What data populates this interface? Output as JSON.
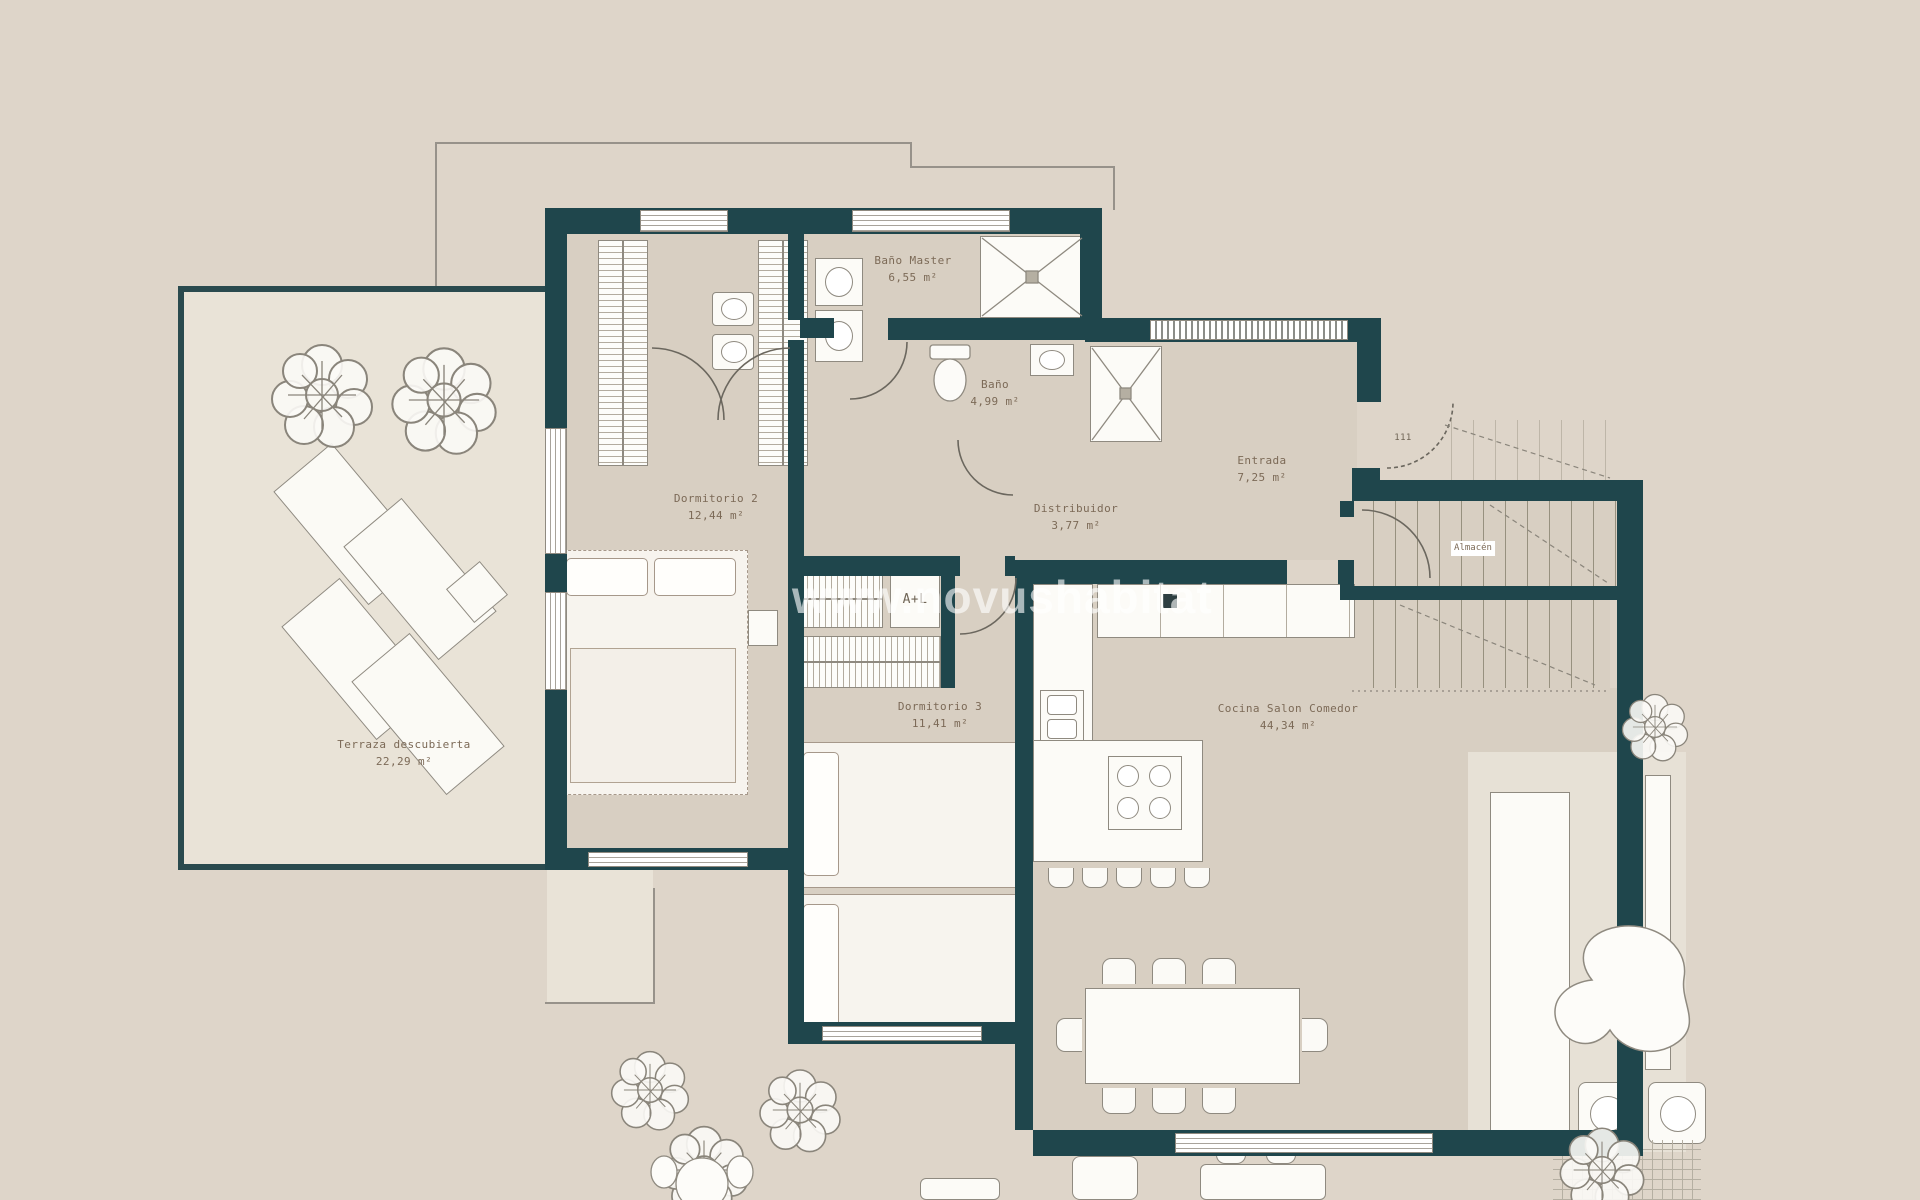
{
  "watermark": {
    "text": "www.novushabitat"
  },
  "entrance": {
    "door_number": "111"
  },
  "rooms": {
    "bano_master": {
      "name": "Baño Master",
      "area": "6,55 m²"
    },
    "bano": {
      "name": "Baño",
      "area": "4,99 m²"
    },
    "dormitorio2": {
      "name": "Dormitorio 2",
      "area": "12,44 m²"
    },
    "distribuidor": {
      "name": "Distribuidor",
      "area": "3,77 m²"
    },
    "entrada": {
      "name": "Entrada",
      "area": "7,25 m²"
    },
    "almacen": {
      "name": "Almacén"
    },
    "dormitorio3": {
      "name": "Dormitorio 3",
      "area": "11,41 m²"
    },
    "cocina_salon": {
      "name": "Cocina Salon Comedor",
      "area": "44,34 m²"
    },
    "terraza": {
      "name": "Terraza descubierta",
      "area": "22,29 m²"
    }
  },
  "labels": {
    "utility_closet": "A+L"
  },
  "colors": {
    "wall": "#1f464c",
    "background": "#ded5c9",
    "room_floor": "#d8cfc2",
    "terrace_floor": "#e9e3d7",
    "label_text": "#7c6a57",
    "watermark": "rgba(255,255,255,0.62)"
  }
}
